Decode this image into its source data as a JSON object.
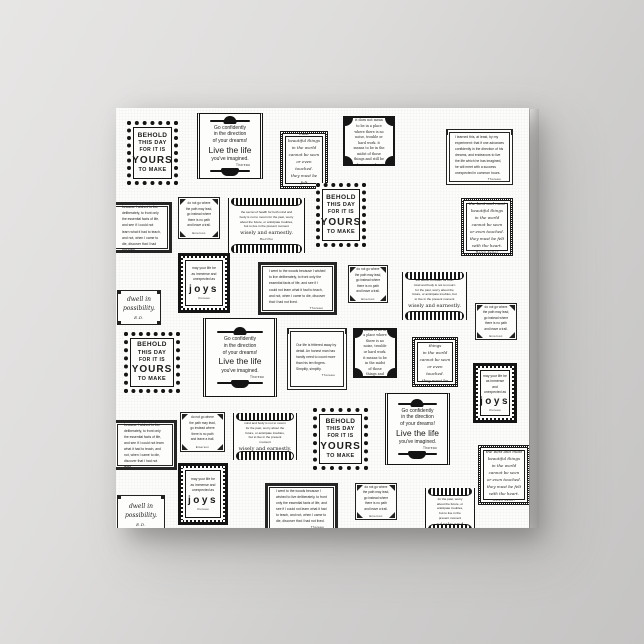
{
  "scene": {
    "background_color_top_left": "#e7e6e5",
    "background_color_bottom_right": "#c5c4c3",
    "canvas_color": "#fcfcfb",
    "ink_color": "#1b1b1b",
    "description": "white wrapped-canvas print covered with a pattern of small black ornamental quote frames"
  },
  "quotes": {
    "behold": {
      "lines": [
        "BEHOLD",
        "THIS DAY",
        "FOR IT IS",
        "YOURS",
        "TO MAKE"
      ]
    },
    "goconf": {
      "lines": [
        "Go confidently",
        "in the direction",
        "of your dreams!"
      ],
      "big": "Live the life",
      "tail": "you've imagined.",
      "attribution": "Thoreau"
    },
    "peace": {
      "title": "peace.",
      "body": "it does not mean to be in a place where there is no noise, trouble or hard work. it means to be in the midst of those things and still be calm in your heart.",
      "attribution": "unknown"
    },
    "success": {
      "body": "I learned this, at least, by my experiment: that if one advances confidently in the direction of his dreams, and endeavors to live the life which he has imagined, he will meet with a success unexpected in common hours.",
      "attribution": "Thoreau"
    },
    "woods": {
      "body": "I went to the woods because I wished to live deliberately, to front only the essential facts of life, and see if I could not learn what it had to teach, and not, when I came to die, discover that I had not lived.",
      "attribution": "Thoreau"
    },
    "simplify": {
      "body": "Our life is frittered away by detail. An honest man has hardly need to count more than his ten fingers. Simplify, simplify.",
      "attribution": "Thoreau"
    },
    "heart": {
      "lines": [
        "the best and most",
        "beautiful things",
        "in the world",
        "cannot be seen",
        "or even touched.",
        "they must be felt",
        "with the heart."
      ],
      "attribution": "Helen Keller"
    },
    "buddha": {
      "lead": "the secret of health for both mind and body is not to mourn for the past, worry about the future, or anticipate troubles, but to live in the present moment",
      "closing": "wisely and earnestly.",
      "attribution": "Buddha"
    },
    "joys": {
      "small": [
        "may your life be",
        "as immense and",
        "unexpected as"
      ],
      "big": "joys",
      "attribution": "thoreau"
    },
    "dwell": {
      "lines": [
        "dwell in",
        "possibility."
      ],
      "attribution": "E.D."
    },
    "path": {
      "lines": [
        "do not go where",
        "the path may lead,",
        "go instead where",
        "there is no path",
        "and leave a trail."
      ],
      "attribution": "Emerson"
    }
  },
  "frames": [
    {
      "style": "behold",
      "quote": "behold",
      "x": 11,
      "y": 13,
      "w": 51,
      "h": 64
    },
    {
      "style": "goconf",
      "quote": "goconf",
      "x": 81,
      "y": 5,
      "w": 66,
      "h": 66
    },
    {
      "style": "script",
      "quote": "heart",
      "x": 164,
      "y": 23,
      "w": 48,
      "h": 58
    },
    {
      "style": "peace",
      "quote": "peace",
      "x": 227,
      "y": 8,
      "w": 52,
      "h": 50
    },
    {
      "style": "thin",
      "quote": "success",
      "x": 330,
      "y": 21,
      "w": 67,
      "h": 56
    },
    {
      "style": "square",
      "quote": "path",
      "x": 62,
      "y": 89,
      "w": 42,
      "h": 42
    },
    {
      "style": "buddha",
      "quote": "buddha",
      "x": 112,
      "y": 90,
      "w": 77,
      "h": 55
    },
    {
      "style": "behold",
      "quote": "behold",
      "x": 200,
      "y": 75,
      "w": 50,
      "h": 64
    },
    {
      "style": "thick",
      "quote": "woods",
      "x": -5,
      "y": 94,
      "w": 61,
      "h": 51
    },
    {
      "style": "script",
      "quote": "heart",
      "x": 345,
      "y": 90,
      "w": 52,
      "h": 58
    },
    {
      "style": "joys",
      "quote": "joys",
      "x": 62,
      "y": 145,
      "w": 52,
      "h": 60
    },
    {
      "style": "thick",
      "quote": "woods",
      "x": 142,
      "y": 154,
      "w": 79,
      "h": 53
    },
    {
      "style": "square",
      "quote": "path",
      "x": 232,
      "y": 157,
      "w": 40,
      "h": 38
    },
    {
      "style": "buddha",
      "quote": "buddha",
      "x": 286,
      "y": 164,
      "w": 65,
      "h": 48
    },
    {
      "style": "dwell",
      "quote": "dwell",
      "x": 1,
      "y": 182,
      "w": 44,
      "h": 35
    },
    {
      "style": "square",
      "quote": "path",
      "x": 359,
      "y": 195,
      "w": 42,
      "h": 37
    },
    {
      "style": "behold",
      "quote": "behold",
      "x": 8,
      "y": 224,
      "w": 56,
      "h": 61
    },
    {
      "style": "goconf",
      "quote": "goconf",
      "x": 87,
      "y": 210,
      "w": 74,
      "h": 79
    },
    {
      "style": "thin",
      "quote": "simplify",
      "x": 171,
      "y": 220,
      "w": 60,
      "h": 62
    },
    {
      "style": "peace",
      "quote": "peace",
      "x": 237,
      "y": 220,
      "w": 44,
      "h": 50
    },
    {
      "style": "script",
      "quote": "heart",
      "x": 296,
      "y": 229,
      "w": 46,
      "h": 50
    },
    {
      "style": "joys",
      "quote": "joys",
      "x": 357,
      "y": 255,
      "w": 44,
      "h": 60
    },
    {
      "style": "thick",
      "quote": "woods",
      "x": -3,
      "y": 312,
      "w": 64,
      "h": 50
    },
    {
      "style": "square",
      "quote": "path",
      "x": 64,
      "y": 304,
      "w": 45,
      "h": 40
    },
    {
      "style": "buddha",
      "quote": "buddha",
      "x": 117,
      "y": 305,
      "w": 64,
      "h": 47
    },
    {
      "style": "behold",
      "quote": "behold",
      "x": 197,
      "y": 300,
      "w": 55,
      "h": 62
    },
    {
      "style": "goconf",
      "quote": "goconf",
      "x": 269,
      "y": 285,
      "w": 65,
      "h": 72
    },
    {
      "style": "script",
      "quote": "heart",
      "x": 362,
      "y": 337,
      "w": 52,
      "h": 60
    },
    {
      "style": "joys",
      "quote": "joys",
      "x": 62,
      "y": 355,
      "w": 50,
      "h": 62
    },
    {
      "style": "thick",
      "quote": "woods",
      "x": 149,
      "y": 375,
      "w": 73,
      "h": 50
    },
    {
      "style": "square",
      "quote": "path",
      "x": 239,
      "y": 375,
      "w": 42,
      "h": 37
    },
    {
      "style": "buddha",
      "quote": "buddha",
      "x": 309,
      "y": 380,
      "w": 50,
      "h": 45
    },
    {
      "style": "dwell",
      "quote": "dwell",
      "x": 1,
      "y": 387,
      "w": 48,
      "h": 38
    }
  ]
}
